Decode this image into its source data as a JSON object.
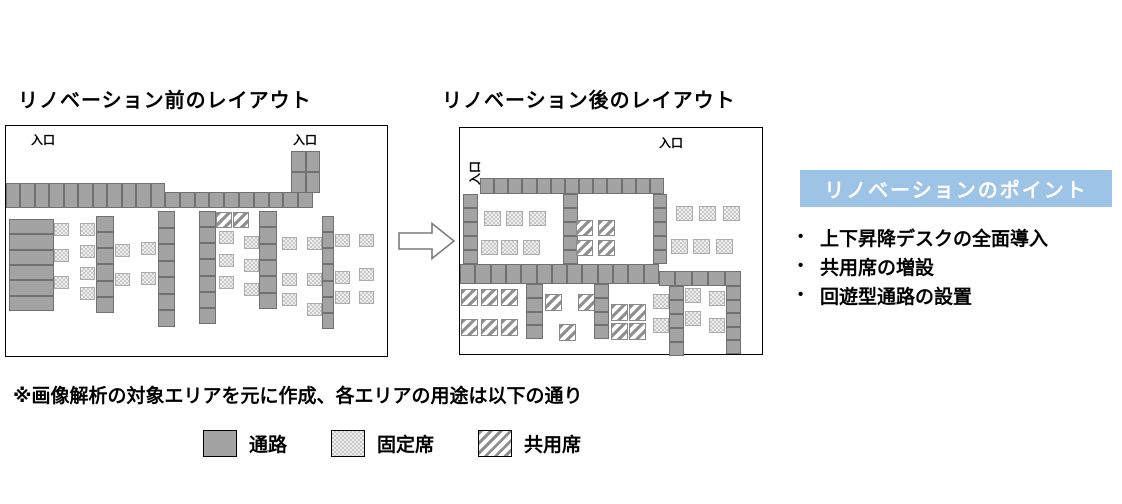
{
  "titles": {
    "before": "リノベーション前のレイアウト",
    "after": "リノベーション後のレイアウト"
  },
  "entrance_label": "入口",
  "note": "※画像解析の対象エリアを元に作成、各エリアの用途は以下の通り",
  "legend": [
    {
      "kind": "aisle",
      "label": "通路"
    },
    {
      "kind": "fixed",
      "label": "固定席"
    },
    {
      "kind": "shared",
      "label": "共用席"
    }
  ],
  "points_panel": {
    "title": "リノベーションのポイント",
    "bullets": [
      "上下昇降デスクの全面導入",
      "共用席の増設",
      "回遊型通路の設置"
    ],
    "bullet_glyph": "•"
  },
  "colors": {
    "aisle": "#a3a3a3",
    "aisle_border": "#717171",
    "checker": "#c9c9c9",
    "stripe": "#8f8f8f",
    "accent_blue": "#9dc3e6"
  },
  "layouts": {
    "before": {
      "box": {
        "x": 5,
        "y": 125,
        "w": 383,
        "h": 232
      },
      "entrances": [
        {
          "x": 25,
          "y": 5,
          "rot": false
        },
        {
          "x": 287,
          "y": 5,
          "rot": false
        }
      ],
      "shapes": [
        {
          "k": "aisle",
          "x": 0,
          "y": 57,
          "w": 159,
          "h": 25,
          "c": 11,
          "r": 1
        },
        {
          "k": "aisle",
          "x": 159,
          "y": 66,
          "w": 148,
          "h": 16,
          "c": 10,
          "r": 1
        },
        {
          "k": "aisle",
          "x": 285,
          "y": 25,
          "w": 29,
          "h": 42,
          "c": 2,
          "r": 2
        },
        {
          "k": "aisle",
          "x": 3,
          "y": 93,
          "w": 45,
          "h": 92,
          "c": 1,
          "r": 6
        },
        {
          "k": "fixed",
          "x": 48,
          "y": 97,
          "w": 15,
          "h": 13
        },
        {
          "k": "fixed",
          "x": 48,
          "y": 123,
          "w": 15,
          "h": 13
        },
        {
          "k": "fixed",
          "x": 48,
          "y": 150,
          "w": 15,
          "h": 13
        },
        {
          "k": "fixed",
          "x": 74,
          "y": 97,
          "w": 15,
          "h": 13
        },
        {
          "k": "fixed",
          "x": 74,
          "y": 119,
          "w": 15,
          "h": 13
        },
        {
          "k": "fixed",
          "x": 74,
          "y": 141,
          "w": 15,
          "h": 13
        },
        {
          "k": "fixed",
          "x": 74,
          "y": 161,
          "w": 15,
          "h": 13
        },
        {
          "k": "aisle",
          "x": 90,
          "y": 90,
          "w": 18,
          "h": 97,
          "c": 1,
          "r": 6
        },
        {
          "k": "fixed",
          "x": 109,
          "y": 118,
          "w": 15,
          "h": 13
        },
        {
          "k": "fixed",
          "x": 109,
          "y": 147,
          "w": 15,
          "h": 13
        },
        {
          "k": "fixed",
          "x": 135,
          "y": 116,
          "w": 15,
          "h": 13
        },
        {
          "k": "fixed",
          "x": 135,
          "y": 146,
          "w": 15,
          "h": 13
        },
        {
          "k": "aisle",
          "x": 152,
          "y": 85,
          "w": 17,
          "h": 116,
          "c": 1,
          "r": 7
        },
        {
          "k": "aisle",
          "x": 193,
          "y": 85,
          "w": 17,
          "h": 113,
          "c": 1,
          "r": 7
        },
        {
          "k": "shared",
          "x": 210,
          "y": 86,
          "w": 16,
          "h": 16
        },
        {
          "k": "shared",
          "x": 227,
          "y": 86,
          "w": 16,
          "h": 16
        },
        {
          "k": "fixed",
          "x": 213,
          "y": 105,
          "w": 15,
          "h": 13
        },
        {
          "k": "fixed",
          "x": 213,
          "y": 128,
          "w": 15,
          "h": 13
        },
        {
          "k": "fixed",
          "x": 213,
          "y": 150,
          "w": 15,
          "h": 13
        },
        {
          "k": "fixed",
          "x": 238,
          "y": 110,
          "w": 15,
          "h": 13
        },
        {
          "k": "fixed",
          "x": 238,
          "y": 133,
          "w": 15,
          "h": 13
        },
        {
          "k": "fixed",
          "x": 238,
          "y": 157,
          "w": 15,
          "h": 13
        },
        {
          "k": "aisle",
          "x": 253,
          "y": 85,
          "w": 18,
          "h": 98,
          "c": 1,
          "r": 6
        },
        {
          "k": "fixed",
          "x": 276,
          "y": 111,
          "w": 15,
          "h": 13
        },
        {
          "k": "fixed",
          "x": 276,
          "y": 147,
          "w": 15,
          "h": 13
        },
        {
          "k": "fixed",
          "x": 276,
          "y": 167,
          "w": 15,
          "h": 13
        },
        {
          "k": "fixed",
          "x": 301,
          "y": 111,
          "w": 15,
          "h": 13
        },
        {
          "k": "fixed",
          "x": 301,
          "y": 147,
          "w": 15,
          "h": 13
        },
        {
          "k": "fixed",
          "x": 301,
          "y": 177,
          "w": 15,
          "h": 13
        },
        {
          "k": "aisle",
          "x": 316,
          "y": 90,
          "w": 12,
          "h": 113,
          "c": 1,
          "r": 7
        },
        {
          "k": "fixed",
          "x": 329,
          "y": 108,
          "w": 15,
          "h": 13
        },
        {
          "k": "fixed",
          "x": 329,
          "y": 145,
          "w": 15,
          "h": 13
        },
        {
          "k": "fixed",
          "x": 329,
          "y": 165,
          "w": 15,
          "h": 13
        },
        {
          "k": "fixed",
          "x": 353,
          "y": 108,
          "w": 15,
          "h": 13
        },
        {
          "k": "fixed",
          "x": 353,
          "y": 142,
          "w": 15,
          "h": 13
        },
        {
          "k": "fixed",
          "x": 353,
          "y": 165,
          "w": 15,
          "h": 13
        }
      ]
    },
    "after": {
      "box": {
        "x": 459,
        "y": 127,
        "w": 304,
        "h": 228
      },
      "entrances": [
        {
          "x": 199,
          "y": 6,
          "rot": false
        },
        {
          "x": 6,
          "y": 57,
          "rot": true
        }
      ],
      "shapes": [
        {
          "k": "aisle",
          "x": 20,
          "y": 50,
          "w": 184,
          "h": 16,
          "c": 13,
          "r": 1
        },
        {
          "k": "aisle",
          "x": 3,
          "y": 66,
          "w": 15,
          "h": 70,
          "c": 1,
          "r": 5
        },
        {
          "k": "aisle",
          "x": 103,
          "y": 66,
          "w": 15,
          "h": 70,
          "c": 1,
          "r": 5
        },
        {
          "k": "aisle",
          "x": 193,
          "y": 66,
          "w": 14,
          "h": 70,
          "c": 1,
          "r": 5
        },
        {
          "k": "fixed",
          "x": 24,
          "y": 83,
          "w": 17,
          "h": 15
        },
        {
          "k": "fixed",
          "x": 46,
          "y": 83,
          "w": 17,
          "h": 15
        },
        {
          "k": "fixed",
          "x": 69,
          "y": 83,
          "w": 17,
          "h": 15
        },
        {
          "k": "fixed",
          "x": 21,
          "y": 112,
          "w": 17,
          "h": 15
        },
        {
          "k": "fixed",
          "x": 41,
          "y": 112,
          "w": 17,
          "h": 15
        },
        {
          "k": "fixed",
          "x": 63,
          "y": 112,
          "w": 17,
          "h": 15
        },
        {
          "k": "shared",
          "x": 116,
          "y": 92,
          "w": 17,
          "h": 16
        },
        {
          "k": "shared",
          "x": 138,
          "y": 92,
          "w": 17,
          "h": 16
        },
        {
          "k": "shared",
          "x": 116,
          "y": 112,
          "w": 17,
          "h": 16
        },
        {
          "k": "shared",
          "x": 138,
          "y": 112,
          "w": 17,
          "h": 16
        },
        {
          "k": "fixed",
          "x": 216,
          "y": 78,
          "w": 17,
          "h": 15
        },
        {
          "k": "fixed",
          "x": 239,
          "y": 78,
          "w": 17,
          "h": 15
        },
        {
          "k": "fixed",
          "x": 263,
          "y": 78,
          "w": 17,
          "h": 15
        },
        {
          "k": "fixed",
          "x": 211,
          "y": 111,
          "w": 17,
          "h": 15
        },
        {
          "k": "fixed",
          "x": 233,
          "y": 111,
          "w": 17,
          "h": 15
        },
        {
          "k": "fixed",
          "x": 256,
          "y": 111,
          "w": 17,
          "h": 15
        },
        {
          "k": "aisle",
          "x": 0,
          "y": 136,
          "w": 199,
          "h": 20,
          "c": 13,
          "r": 1
        },
        {
          "k": "aisle",
          "x": 199,
          "y": 143,
          "w": 82,
          "h": 15,
          "c": 5,
          "r": 1
        },
        {
          "k": "aisle",
          "x": 266,
          "y": 158,
          "w": 15,
          "h": 68,
          "c": 1,
          "r": 5
        },
        {
          "k": "shared",
          "x": 1,
          "y": 161,
          "w": 17,
          "h": 17
        },
        {
          "k": "shared",
          "x": 21,
          "y": 161,
          "w": 17,
          "h": 17
        },
        {
          "k": "shared",
          "x": 41,
          "y": 161,
          "w": 17,
          "h": 17
        },
        {
          "k": "shared",
          "x": 1,
          "y": 191,
          "w": 17,
          "h": 17
        },
        {
          "k": "shared",
          "x": 21,
          "y": 191,
          "w": 17,
          "h": 17
        },
        {
          "k": "shared",
          "x": 41,
          "y": 191,
          "w": 17,
          "h": 17
        },
        {
          "k": "aisle",
          "x": 66,
          "y": 156,
          "w": 17,
          "h": 55,
          "c": 1,
          "r": 4
        },
        {
          "k": "shared",
          "x": 85,
          "y": 166,
          "w": 17,
          "h": 17
        },
        {
          "k": "shared",
          "x": 99,
          "y": 196,
          "w": 17,
          "h": 17
        },
        {
          "k": "shared",
          "x": 118,
          "y": 166,
          "w": 17,
          "h": 17
        },
        {
          "k": "aisle",
          "x": 134,
          "y": 156,
          "w": 15,
          "h": 55,
          "c": 1,
          "r": 4
        },
        {
          "k": "shared",
          "x": 151,
          "y": 176,
          "w": 17,
          "h": 17
        },
        {
          "k": "shared",
          "x": 169,
          "y": 176,
          "w": 17,
          "h": 17
        },
        {
          "k": "shared",
          "x": 151,
          "y": 195,
          "w": 17,
          "h": 17
        },
        {
          "k": "shared",
          "x": 169,
          "y": 195,
          "w": 17,
          "h": 17
        },
        {
          "k": "fixed",
          "x": 193,
          "y": 166,
          "w": 16,
          "h": 15
        },
        {
          "k": "fixed",
          "x": 193,
          "y": 190,
          "w": 16,
          "h": 15
        },
        {
          "k": "aisle",
          "x": 209,
          "y": 158,
          "w": 15,
          "h": 70,
          "c": 1,
          "r": 5
        },
        {
          "k": "fixed",
          "x": 225,
          "y": 160,
          "w": 16,
          "h": 15
        },
        {
          "k": "fixed",
          "x": 225,
          "y": 183,
          "w": 16,
          "h": 15
        },
        {
          "k": "fixed",
          "x": 249,
          "y": 163,
          "w": 16,
          "h": 15
        },
        {
          "k": "fixed",
          "x": 249,
          "y": 190,
          "w": 16,
          "h": 15
        }
      ]
    }
  }
}
